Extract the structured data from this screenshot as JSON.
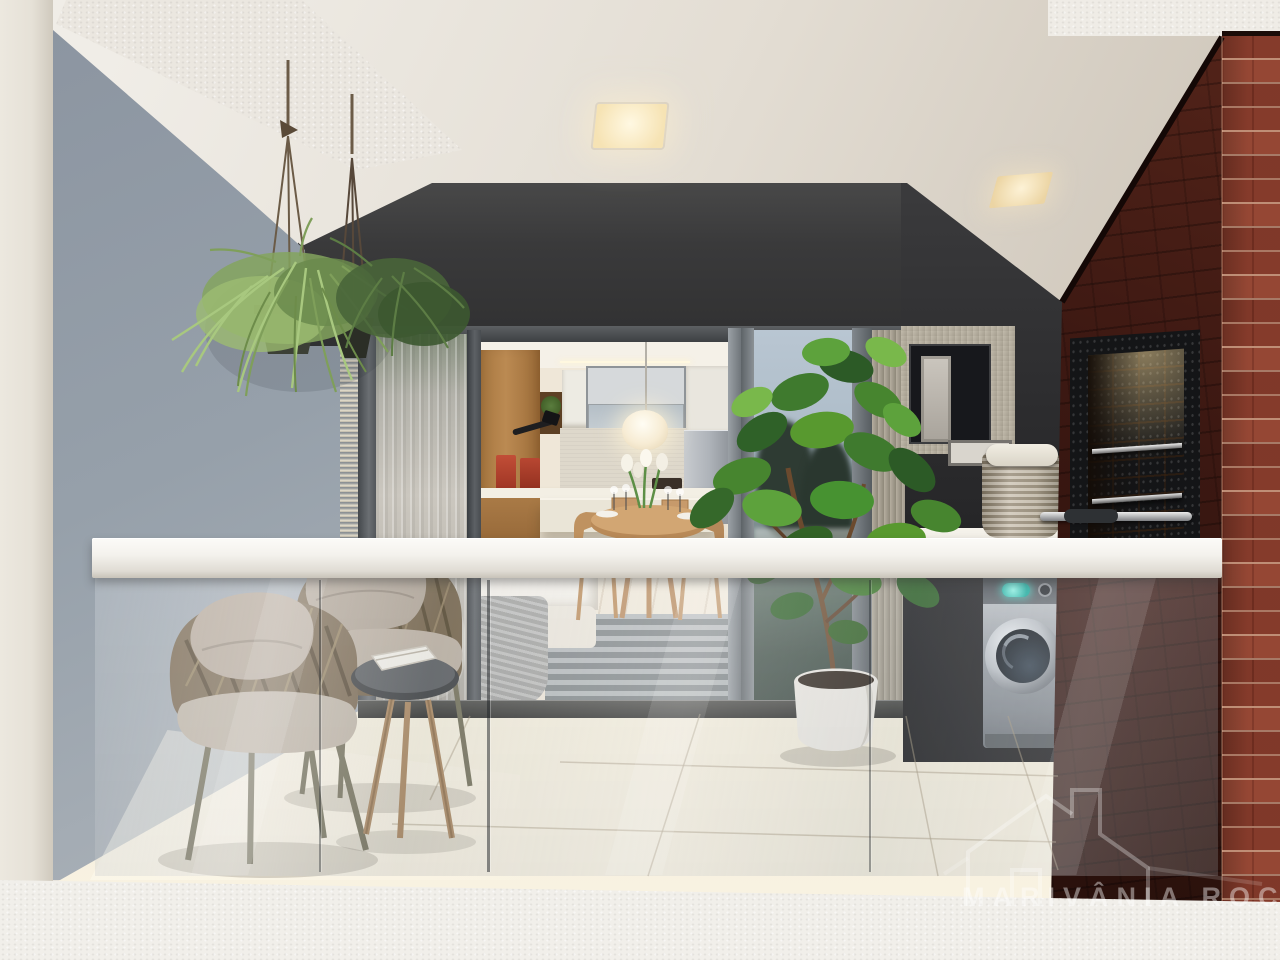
{
  "image": {
    "kind": "architectural-3d-render",
    "subject": "Apartment balcony seen from outside through a frameless glass railing: woven armchairs with cushions, round side table, potted fiddle-leaf fig, hanging plants, sliding glass doors to a kitchen and dining room, laundry nook with washing machine and basket, and a red brick pillar with a built-in barbecue grill"
  },
  "watermark": {
    "text": "MARIVÂNIA ROCHA",
    "icon": "house-outline-icon"
  },
  "palette": {
    "wall_white": "#e9e5de",
    "side_wall_gray": "#9aa3ad",
    "header_charcoal": "#39393b",
    "dark_wall": "#2f2f31",
    "brick_red": "#8e4130",
    "brick_shadow": "#2a120d",
    "floor_cream": "#efe8d6",
    "rail_white": "#f4f2ee",
    "plant_green": "#4f8c3a",
    "washer_silver": "#b4b8bd",
    "washer_display_teal": "#49e3d4",
    "kitchen_wood": "#b98a5a",
    "grill_brick_warm": "#c29a5f"
  },
  "objects": [
    "left-facade-strip",
    "balcony-ceiling",
    "recessed-lights",
    "hanging-plants",
    "side-wall",
    "sliding-glass-doors",
    "sheer-curtain",
    "kitchen-interior",
    "pendant-lamp",
    "dining-set",
    "sofa",
    "fiddle-leaf-fig",
    "glass-railing",
    "handrail",
    "woven-armchairs",
    "side-table",
    "tile-floor",
    "laundry-window",
    "picture-frame",
    "laundry-basket",
    "washing-machine",
    "counter",
    "brick-pillar",
    "barbecue-grill",
    "facade-slab",
    "watermark"
  ]
}
